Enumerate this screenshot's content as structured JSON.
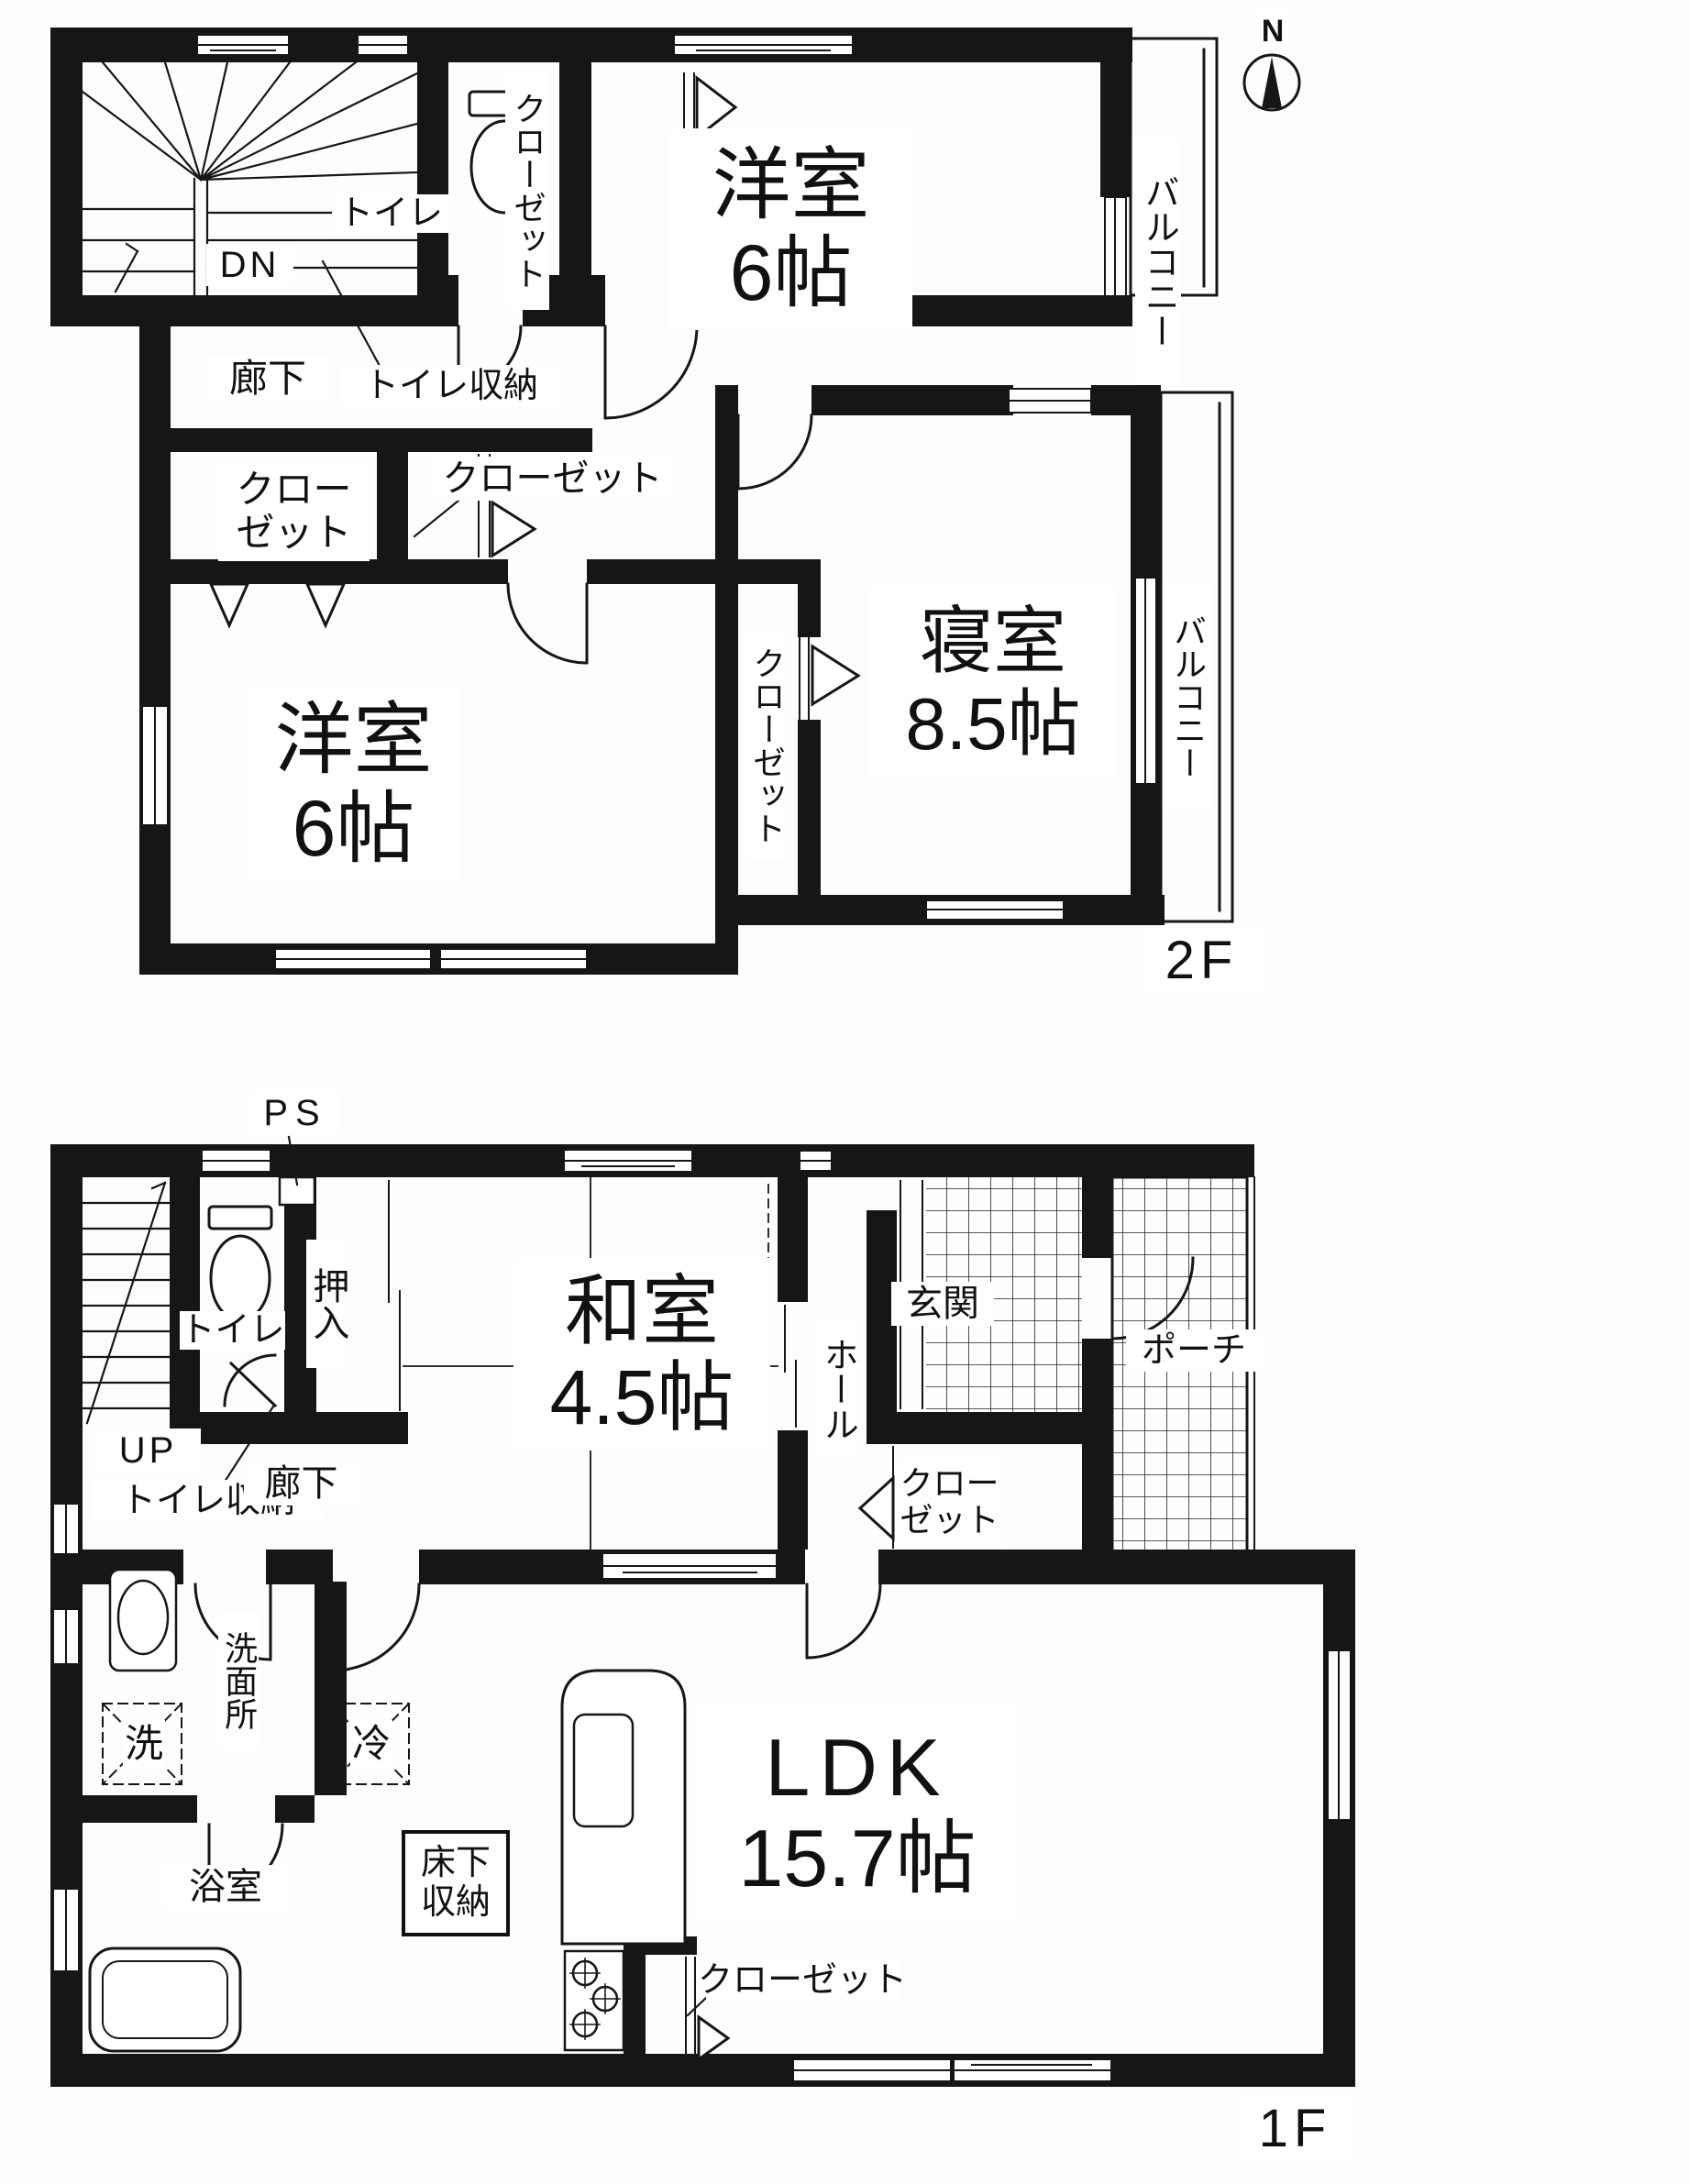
{
  "compass": {
    "north": "N"
  },
  "floor2": {
    "floor_label": "2F",
    "stairs": {
      "direction": "DN"
    },
    "toilet": "トイレ",
    "toilet_storage": "トイレ収納",
    "hallway": "廊下",
    "closet_top_vertical": "クローゼット",
    "closet_left": {
      "line1": "クロー",
      "line2": "ゼット"
    },
    "closet_mid": "クローゼット",
    "closet_center_vertical": "クローゼット",
    "room_top": {
      "name": "洋室",
      "size": "6帖"
    },
    "room_bottom": {
      "name": "洋室",
      "size": "6帖"
    },
    "bedroom": {
      "name": "寝室",
      "size": "8.5帖"
    },
    "balcony_top": "バルコニー",
    "balcony_right": "バルコニー"
  },
  "floor1": {
    "floor_label": "1F",
    "ps": "PS",
    "stairs": {
      "direction": "UP"
    },
    "toilet": "トイレ",
    "toilet_storage": "トイレ収納",
    "hallway": "廊下",
    "oshiire": "押入",
    "washitsu": {
      "name": "和室",
      "size": "4.5帖"
    },
    "hall": "ホール",
    "genkan": "玄関",
    "porch": "ポーチ",
    "closet_hall": {
      "line1": "クロー",
      "line2": "ゼット"
    },
    "senmenjo": "洗面所",
    "washer": "洗",
    "fridge": "冷",
    "bathroom": "浴室",
    "underfloor": {
      "line1": "床下",
      "line2": "収納"
    },
    "ldk": {
      "name": "LDK",
      "size": "15.7帖"
    },
    "closet_ldk": "クローゼット"
  }
}
